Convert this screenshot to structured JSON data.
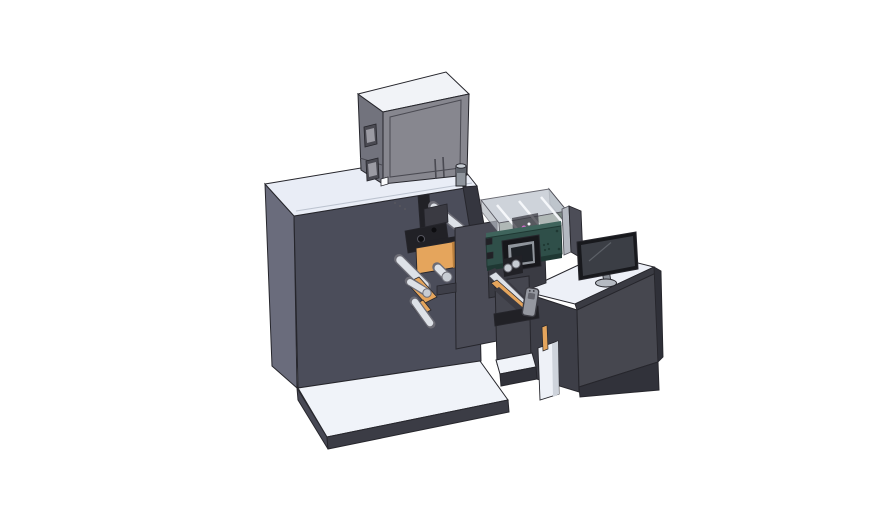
{
  "scene": {
    "kind": "3d-cad-render",
    "subject": "label-printing-machine-with-operator-desk",
    "parts": [
      "base-platform",
      "machine-cabinet",
      "control-box",
      "top-cylinder",
      "print-mechanism",
      "unwind-orange-frame",
      "guide-rollers",
      "front-plate",
      "web-ramp",
      "electronics-enclosure",
      "hmi-panel",
      "transparent-cover",
      "support-pedestal",
      "handheld-remote",
      "operator-desk",
      "side-shield",
      "monitor"
    ]
  },
  "palette": {
    "bg": "#ffffff",
    "outline": "#26262c",
    "outlineSoft": "#55555e",
    "cabinetFront": "#4b4d5a",
    "cabinetLeft": "#6a6c7c",
    "cabinetRight": "#35363f",
    "topLight": "#e9edf6",
    "topLighter": "#f0f3f9",
    "topSeam": "#bcc3cf",
    "baseFront": "#3b3c45",
    "baseLeft": "#474854",
    "boxFront": "#87878f",
    "boxLeft": "#72737d",
    "boxTop": "#f1f3f7",
    "boxDetail": "#4a4a52",
    "boxInner": "#9b9ba3",
    "cylBody": "#8f959d",
    "cylDark": "#5f646c",
    "cylTop": "#c6ccd3",
    "mech": "#212126",
    "mechDeep": "#0d0d10",
    "mechMid": "#3a3a42",
    "roller": "#dde1e7",
    "rollerEnd": "#c7ccd3",
    "rollerEdge": "#6c6c75",
    "orange": "#e5a55c",
    "orangeDark": "#b97f3d",
    "plate": "#4a4b56",
    "plateDark": "#3e3f49",
    "teal": "#2f4f49",
    "tealDark": "#1f3833",
    "tealLight": "#3f645c",
    "hmiBezel": "#17171b",
    "hmiFrame": "#90959c",
    "hmiScreen": "#1e2126",
    "coverTop": "#c8ced6",
    "coverSide": "#7d8a86",
    "coverRail": "#f5f7fa",
    "pink": "#d26ccd",
    "deskTop": "#edf0f7",
    "deskFront": "#46474f",
    "deskLeft": "#3d3e47",
    "deskSide": "#2f3038",
    "deskEdge": "#3a3b43",
    "plinth": "#31323a",
    "notchWhite": "#eef1f7",
    "notchShade": "#ced3db",
    "shieldLight": "#b3b8c0",
    "shieldDark": "#4c4d57",
    "monBezel": "#18191d",
    "monScreen": "#3b3e45",
    "monSlash": "#5c6067",
    "monStand": "#8a8f97",
    "monBase": "#b5bac2",
    "remote": "#9598a0",
    "remoteDark": "#3c3c43",
    "pedestal": "#45464f",
    "white": "#fafbfd"
  }
}
